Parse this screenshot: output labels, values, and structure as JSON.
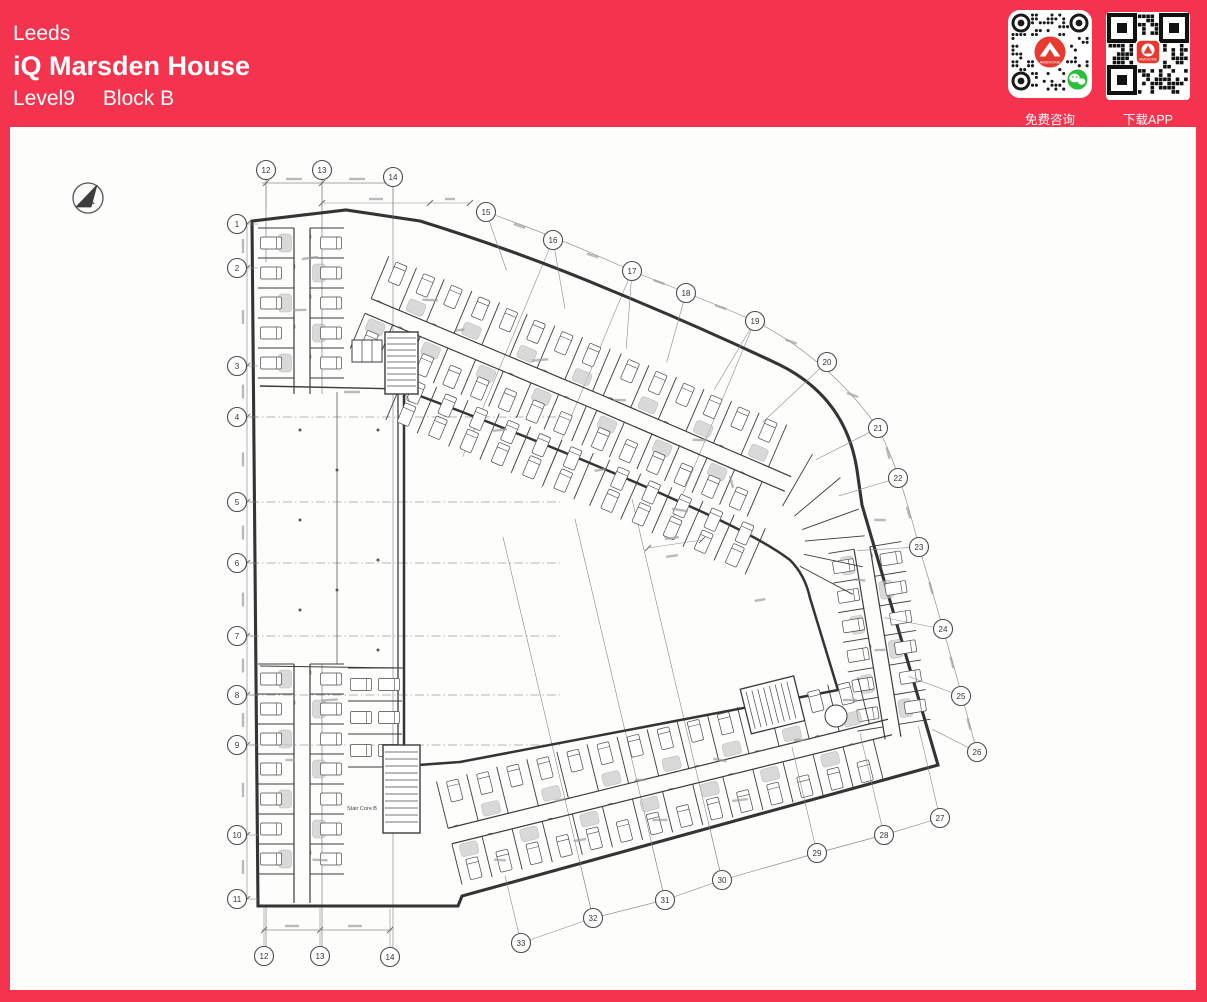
{
  "header": {
    "city": "Leeds",
    "building_name": "iQ Marsden House",
    "level": "Level9",
    "block": "Block B"
  },
  "qr_panel": {
    "consult_label": "免费咨询",
    "download_label": "下载APP",
    "logo_text": "AWEHOME"
  },
  "colors": {
    "brand_red": "#F4334F",
    "logo_red": "#E6392F",
    "wechat_green": "#2BBE39",
    "paper": "#FEFEFE",
    "ink": "#3A3A3C"
  },
  "plan": {
    "north_label": "N",
    "stair_core_b_label": "Stair Core B",
    "grid_bubbles": {
      "left": [
        "1",
        "2",
        "3",
        "4",
        "5",
        "6",
        "7",
        "8",
        "9",
        "10",
        "11"
      ],
      "top": [
        "12",
        "13",
        "14"
      ],
      "ring": [
        "15",
        "16",
        "17",
        "18",
        "19",
        "20",
        "21",
        "22",
        "23",
        "24",
        "25",
        "26"
      ],
      "bottom_ring": [
        "27",
        "28",
        "29",
        "30",
        "31",
        "32",
        "33"
      ],
      "bottom": [
        "12",
        "13",
        "14"
      ]
    }
  }
}
